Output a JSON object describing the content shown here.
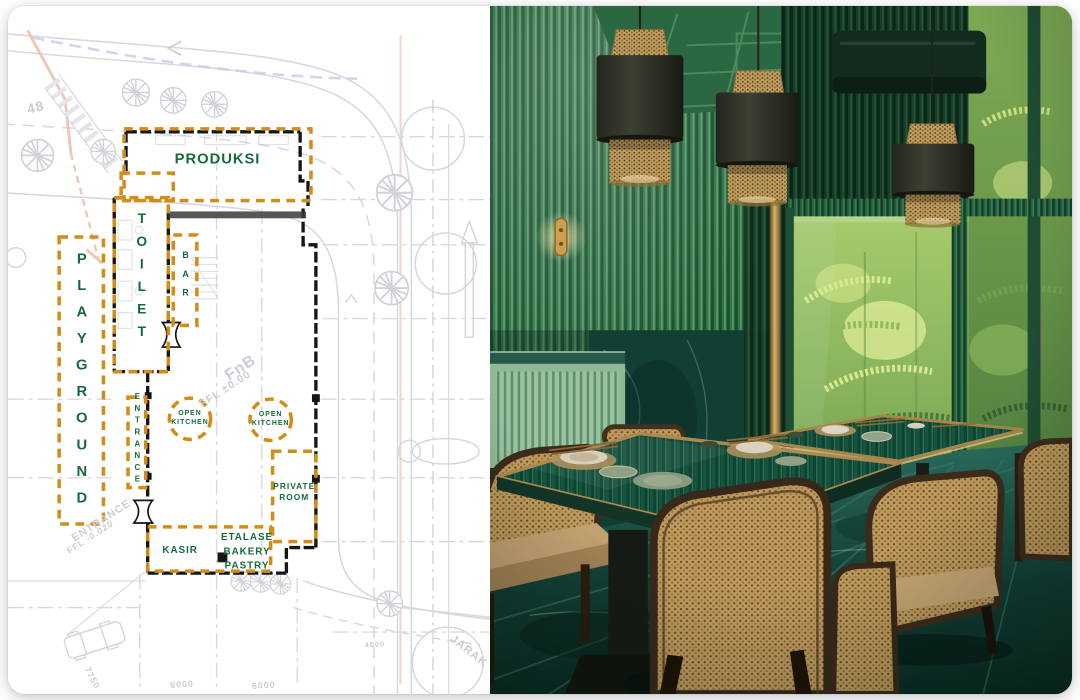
{
  "card": {
    "type": "portfolio-item",
    "left_panel": "site floor plan drawing",
    "right_panel": "restaurant interior photo"
  },
  "colors": {
    "plan_label_green": "#156A3A",
    "plan_zone_orange": "#D28D18",
    "blueprint_line_gray": "#D6D7DE",
    "blueprint_red": "#EFC7B5",
    "blueprint_blue": "#C5CAE8",
    "photo_wall_green": "#2E7347",
    "photo_rattan_tan": "#C09A5E",
    "photo_table_emerald": "#0F4231",
    "photo_brass": "#D6B168",
    "photo_floor_teal": "#123F35"
  },
  "floor_plan": {
    "zones": {
      "produksi": "PRODUKSI",
      "toilet": "TOILET",
      "bar": "BAR",
      "playground": "PLAYGROUND",
      "entrance": "ENTRANCE",
      "open_kitchen": {
        "line1": "OPEN",
        "line2": "KITCHEN"
      },
      "private_room": {
        "line1": "PRIVATE",
        "line2": "ROOM"
      },
      "kasir": "KASIR",
      "etalase": {
        "line1": "ETALASE",
        "line2": "BAKERY",
        "line3": "PASTRY"
      }
    },
    "notes": {
      "fnb": "FnB",
      "fnb_level": "FFL ±0.00",
      "entrance": "ENTRANCE",
      "entrance_level": "FFL -0.020"
    },
    "dimensions": {
      "lot": "48",
      "d7750": "7750",
      "d6000a": "6000",
      "d6000b": "6000",
      "d4000": "4000",
      "street": "JARAK"
    }
  }
}
